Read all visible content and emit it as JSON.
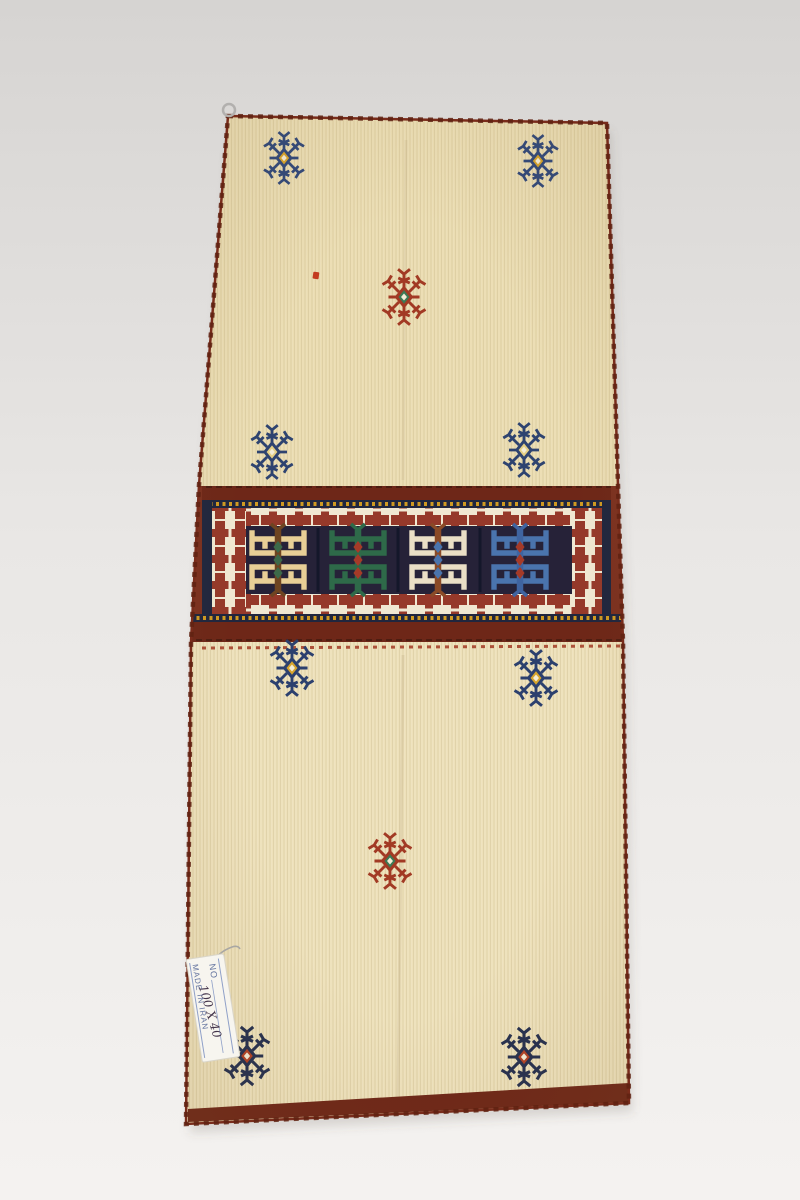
{
  "scene": {
    "description": "Photograph of a cream Persian kilim saddlebag (khorjin) with a central geometric band, laid flat on a pale grey studio backdrop",
    "background_top": "#d6d4d2",
    "background_bottom": "#f4f2f0",
    "shadow_color": "rgba(90,85,80,0.18)"
  },
  "rug": {
    "base_color": "#eee1ba",
    "edge_color": "#792c1b",
    "stitch_color": "#5f2212",
    "outline_points": "228,116 607,123 618,485 623,642 629,1103 186,1124 191,642 199,485",
    "shadow_points": "232,124 611,131 622,493 627,650 633,1112 190,1133 195,650 203,493",
    "corner_ring": {
      "x": 229,
      "y": 110,
      "color": "#b2b0ae"
    },
    "red_fleck": {
      "x": 313,
      "y": 272,
      "color": "#c33b20"
    },
    "crease_color": "rgba(120,90,50,0.10)"
  },
  "band": {
    "maroon": "#6e2718",
    "maroon_edge": "#7c3120",
    "navy_field": "#262238",
    "stripe_navy": "#20263e",
    "dot_yellow": "#cf9a22",
    "crenel_red": "#95392a",
    "crenel_bg": "#f0e8d2",
    "separator_dark": "#14172a",
    "thin_red_line": "#a23a24",
    "hooked_motifs": [
      {
        "x": 278,
        "y": 560,
        "main": "#e8cf96",
        "spine": "#6e4421",
        "accent": "#3d6a4a"
      },
      {
        "x": 358,
        "y": 560,
        "main": "#2e6a49",
        "spine": "#2e6a49",
        "accent": "#a53a28"
      },
      {
        "x": 438,
        "y": 560,
        "main": "#eadfc6",
        "spine": "#8a4a27",
        "accent": "#4a74ad"
      },
      {
        "x": 520,
        "y": 560,
        "main": "#4a74ad",
        "spine": "#3f64a0",
        "accent": "#a53a28"
      }
    ]
  },
  "star_motifs": [
    {
      "x": 284,
      "y": 158,
      "arm": "#31487a",
      "center": "#d7a42c",
      "s": 0.82
    },
    {
      "x": 538,
      "y": 161,
      "arm": "#31487a",
      "center": "#d7a42c",
      "s": 0.82
    },
    {
      "x": 404,
      "y": 297,
      "arm": "#a23a24",
      "center": "#3c7a55",
      "s": 0.88
    },
    {
      "x": 272,
      "y": 452,
      "arm": "#2e4370",
      "center": "#e5cf85",
      "s": 0.85
    },
    {
      "x": 524,
      "y": 450,
      "arm": "#2e4370",
      "center": "#e5cf85",
      "s": 0.85
    },
    {
      "x": 292,
      "y": 668,
      "arm": "#2c406e",
      "center": "#d7a42c",
      "s": 0.88
    },
    {
      "x": 536,
      "y": 678,
      "arm": "#2c406e",
      "center": "#d7a42c",
      "s": 0.88
    },
    {
      "x": 390,
      "y": 861,
      "arm": "#a23a24",
      "center": "#3c7a55",
      "s": 0.88
    },
    {
      "x": 247,
      "y": 1056,
      "arm": "#26304f",
      "center": "#b04226",
      "s": 0.92
    },
    {
      "x": 524,
      "y": 1057,
      "arm": "#26304f",
      "center": "#b04226",
      "s": 0.92
    }
  ],
  "tag": {
    "bg": "#f7f5ef",
    "border": "#d9d5c9",
    "rule_blue": "#8fa0c8",
    "text_color": "#64749f",
    "hand_color": "#43344a",
    "line1": "NO",
    "line2": "100 X 40",
    "line3": "MADE IN IRAN",
    "string_color": "#a9a7a3"
  }
}
